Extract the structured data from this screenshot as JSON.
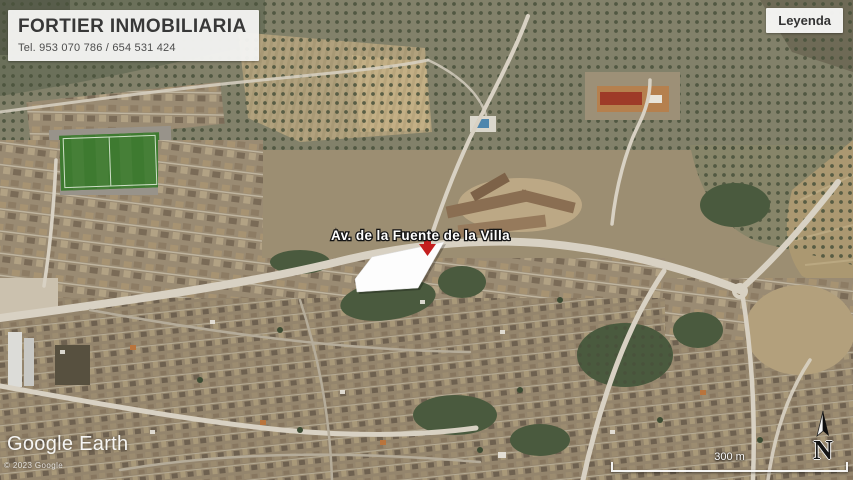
{
  "header": {
    "title": "FORTIER INMOBILIARIA",
    "phone": "Tel. 953 070 786 / 654 531 424"
  },
  "legend": {
    "label": "Leyenda"
  },
  "map": {
    "street_label": "Av. de la Fuente de la Villa",
    "property": {
      "points": "444,242 372,257 355,279 357,292 418,288",
      "fill": "#fdfdfd",
      "arrow_color": "#c41f1f"
    }
  },
  "attribution": {
    "logo": "Google Earth",
    "copyright": "© 2023 Google"
  },
  "compass": {
    "label": "N"
  },
  "scale": {
    "label": "300 m"
  }
}
